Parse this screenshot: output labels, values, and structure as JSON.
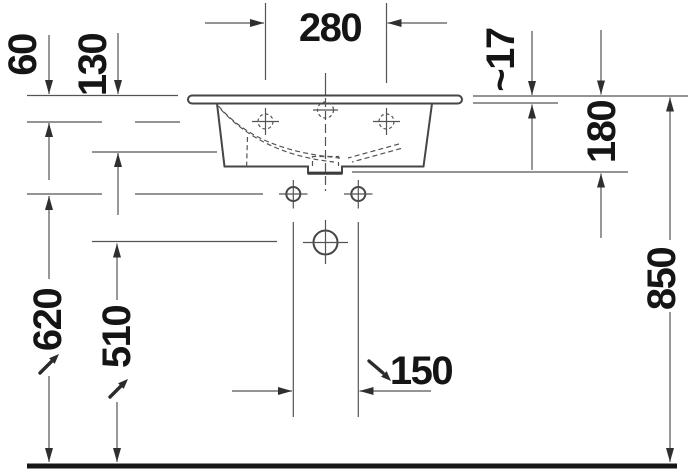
{
  "drawing": {
    "labels": {
      "tap_hole_spacing": "280",
      "rim_to_upper_ref": "60",
      "rim_to_lower_ref": "130",
      "rim_above_counter": "~17",
      "rim_to_basin_underside": "180",
      "floor_to_fixing_holes": "620",
      "floor_to_drain_center": "510",
      "floor_to_rim": "850",
      "fixing_hole_spacing": "150"
    },
    "colors": {
      "outline": "#464646",
      "thin_line": "#545454",
      "text": "#151515",
      "floor": "#161616",
      "background": "#ffffff"
    }
  }
}
